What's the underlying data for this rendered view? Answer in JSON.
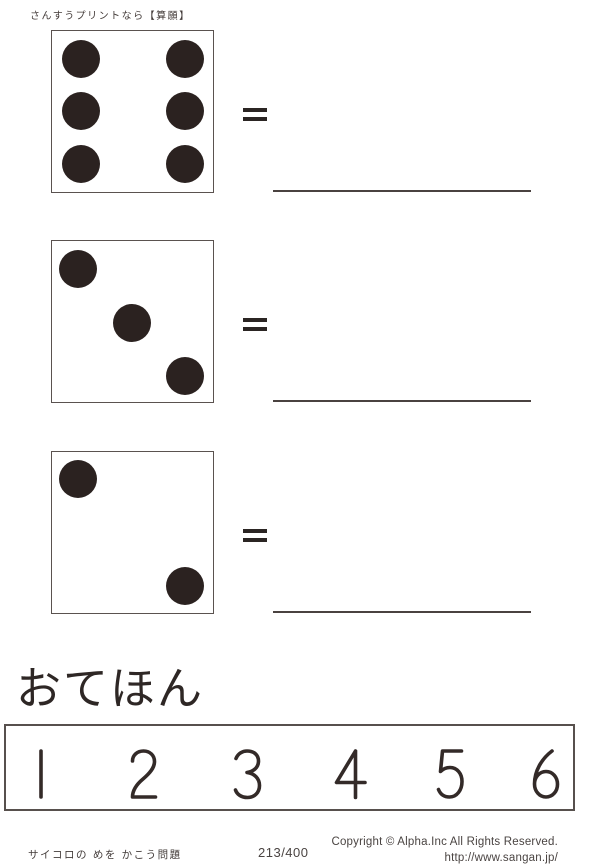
{
  "page": {
    "header_note": "さんすうプリントなら【算願】",
    "background_color": "#ffffff",
    "ink_color": "#2b2220",
    "rule_line_color": "#4a4240",
    "box_border_color": "#57504d"
  },
  "problems": [
    {
      "die_value": 6,
      "equals": "=",
      "answer_value": "",
      "dots": [
        {
          "x": 17.8,
          "y": 17.2
        },
        {
          "x": 82.8,
          "y": 17.2
        },
        {
          "x": 17.8,
          "y": 49.7
        },
        {
          "x": 82.8,
          "y": 49.7
        },
        {
          "x": 17.8,
          "y": 82.8
        },
        {
          "x": 82.8,
          "y": 82.8
        }
      ]
    },
    {
      "die_value": 3,
      "equals": "=",
      "answer_value": "",
      "dots": [
        {
          "x": 16.0,
          "y": 17.2
        },
        {
          "x": 49.7,
          "y": 50.9
        },
        {
          "x": 82.8,
          "y": 84.0
        }
      ]
    },
    {
      "die_value": 2,
      "equals": "=",
      "answer_value": "",
      "dots": [
        {
          "x": 16.0,
          "y": 16.6
        },
        {
          "x": 82.8,
          "y": 83.4
        }
      ]
    }
  ],
  "example": {
    "heading": "おてほん",
    "numbers": [
      "1",
      "2",
      "3",
      "4",
      "5",
      "6"
    ]
  },
  "footer": {
    "worksheet_title": "サイコロの めを かこう問題",
    "page_number": "213/400",
    "copyright": "Copyright ©  Alpha.Inc All Rights Reserved.",
    "url": "http://www.sangan.jp/"
  }
}
